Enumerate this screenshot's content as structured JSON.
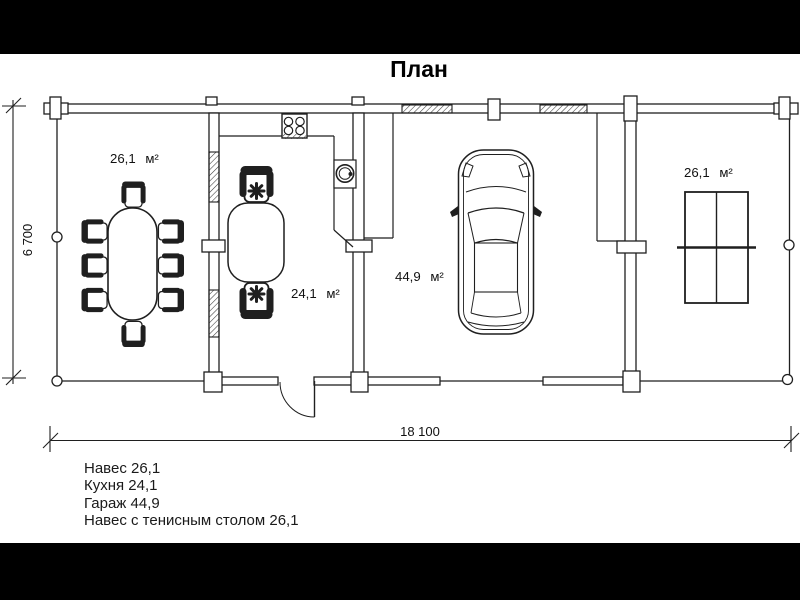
{
  "title": "План",
  "plan": {
    "rooms": [
      {
        "area_label": "26,1 м²"
      },
      {
        "area_label": "24,1 м²"
      },
      {
        "area_label": "44,9 м²"
      },
      {
        "area_label": "26,1 м²"
      }
    ],
    "dimensions": {
      "height_label": "6 700",
      "width_label": "18 100"
    }
  },
  "legend": {
    "items": [
      "Навес 26,1",
      "Кухня 24,1",
      "Гараж 44,9",
      "Навес с тенисным столом 26,1"
    ]
  },
  "colors": {
    "line": "#1f1f1f",
    "background": "#ffffff",
    "letterbox": "#000000",
    "text": "#000000"
  }
}
